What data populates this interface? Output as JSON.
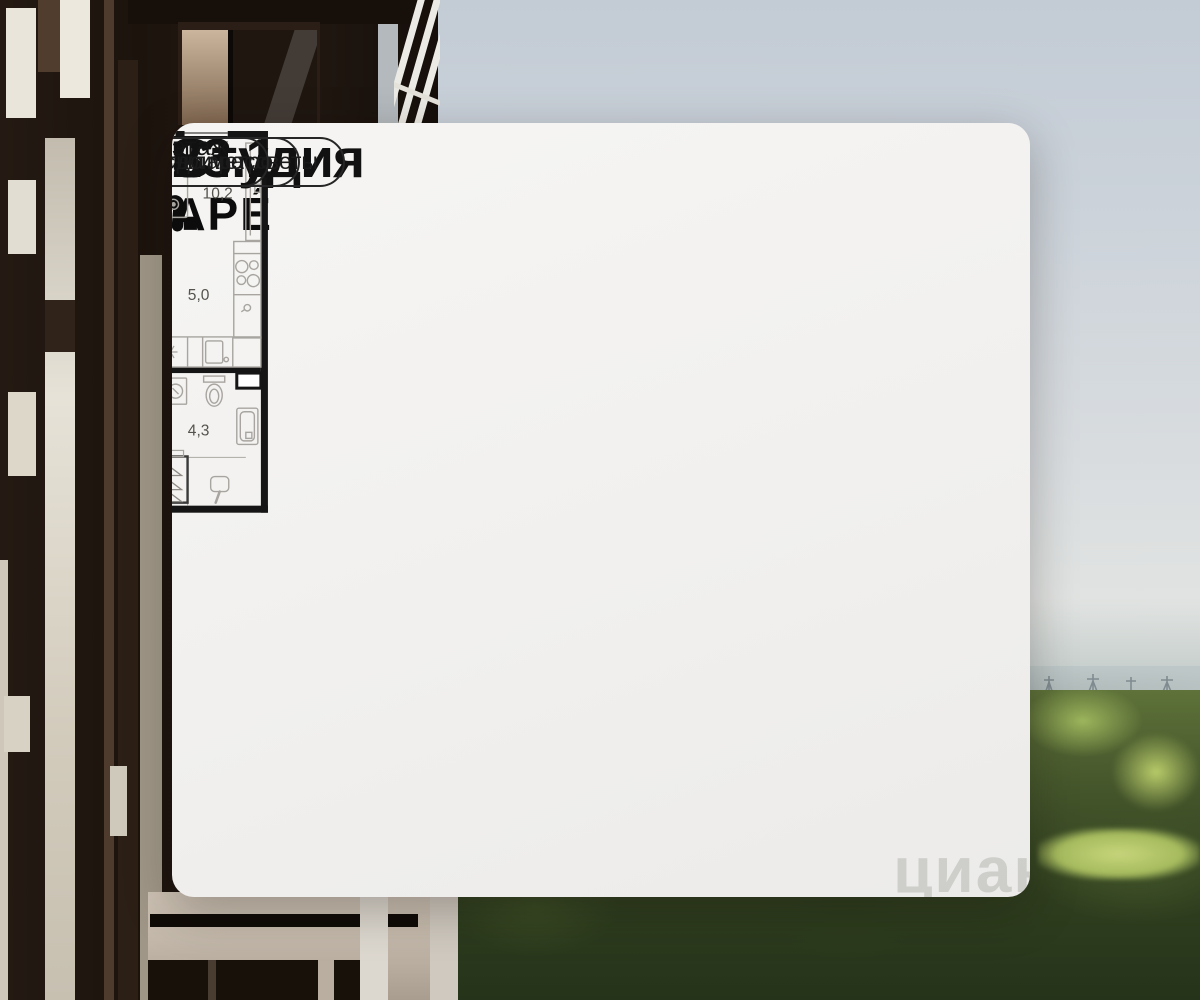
{
  "branding": {
    "logo_text": "НАЗАРЕ́"
  },
  "floor_plan": {
    "rooms": [
      {
        "id": "room-living",
        "area_label": "10,2"
      },
      {
        "id": "room-kitchen",
        "area_label": "5,0"
      },
      {
        "id": "room-hallway",
        "area_label": "3,6"
      },
      {
        "id": "room-bathroom",
        "area_label": "4,3"
      }
    ]
  },
  "summary": {
    "type_label": "Студия",
    "area_value": "23.1",
    "area_unit": "м²",
    "floor_value": "8",
    "floor_unit": "этаж"
  },
  "badges": [
    {
      "label": "2 минуты до метро"
    },
    {
      "label": "виды на закаты и рассветы"
    },
    {
      "label": "бизнес-класс"
    }
  ],
  "watermark": {
    "text": "циан"
  },
  "colors": {
    "card_bg": "#f2f1ef",
    "text_primary": "#111111",
    "badge_border": "#262626",
    "plan_wall": "#151515",
    "plan_furniture": "#a8a5a0",
    "plan_label": "#55534e",
    "trees": "#46572c",
    "facade_dark": "#1c130d"
  }
}
